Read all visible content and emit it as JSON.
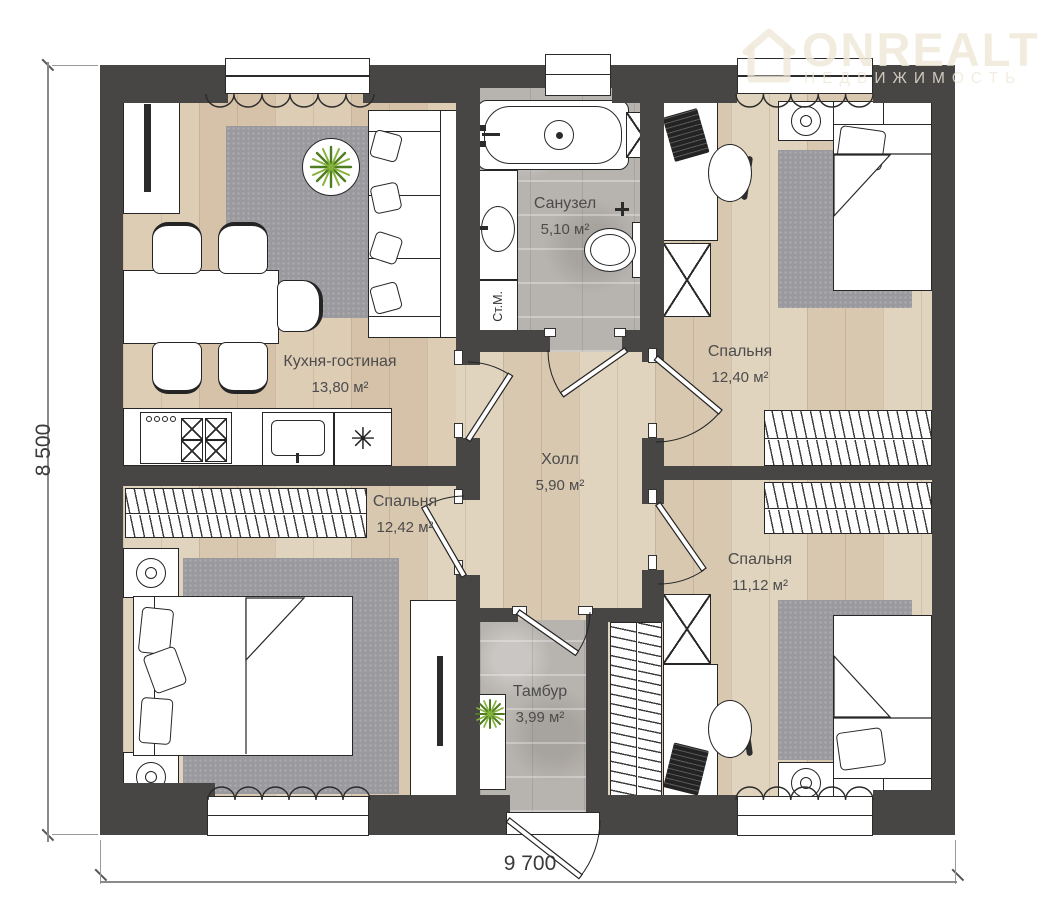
{
  "logo": {
    "brand": "ONREALT",
    "subtitle": "НЕДВИЖИМОСТЬ"
  },
  "dimensions": {
    "left": "8 500",
    "bottom": "9 700"
  },
  "rooms": {
    "kitchen_living": {
      "name": "Кухня-гостиная",
      "area": "13,80 м²"
    },
    "bathroom": {
      "name": "Санузел",
      "area": "5,10 м²"
    },
    "bedroom_top_right": {
      "name": "Спальня",
      "area": "12,40 м²"
    },
    "hall": {
      "name": "Холл",
      "area": "5,90 м²"
    },
    "bedroom_left": {
      "name": "Спальня",
      "area": "12,42 м²"
    },
    "bedroom_bottom_right": {
      "name": "Спальня",
      "area": "11,12 м²"
    },
    "vestibule": {
      "name": "Тамбур",
      "area": "3,99 м²"
    }
  },
  "equipment": {
    "washing_machine": "Ст.М."
  },
  "icons": {
    "fridge": "✳"
  },
  "colors": {
    "wall": "#474645",
    "wood_floor": "#ddcfb7",
    "tile_floor": "#b7b3af",
    "rug": "#9a999d",
    "plant": "#5e8f23",
    "logo_watermark": "#f0e9db"
  }
}
